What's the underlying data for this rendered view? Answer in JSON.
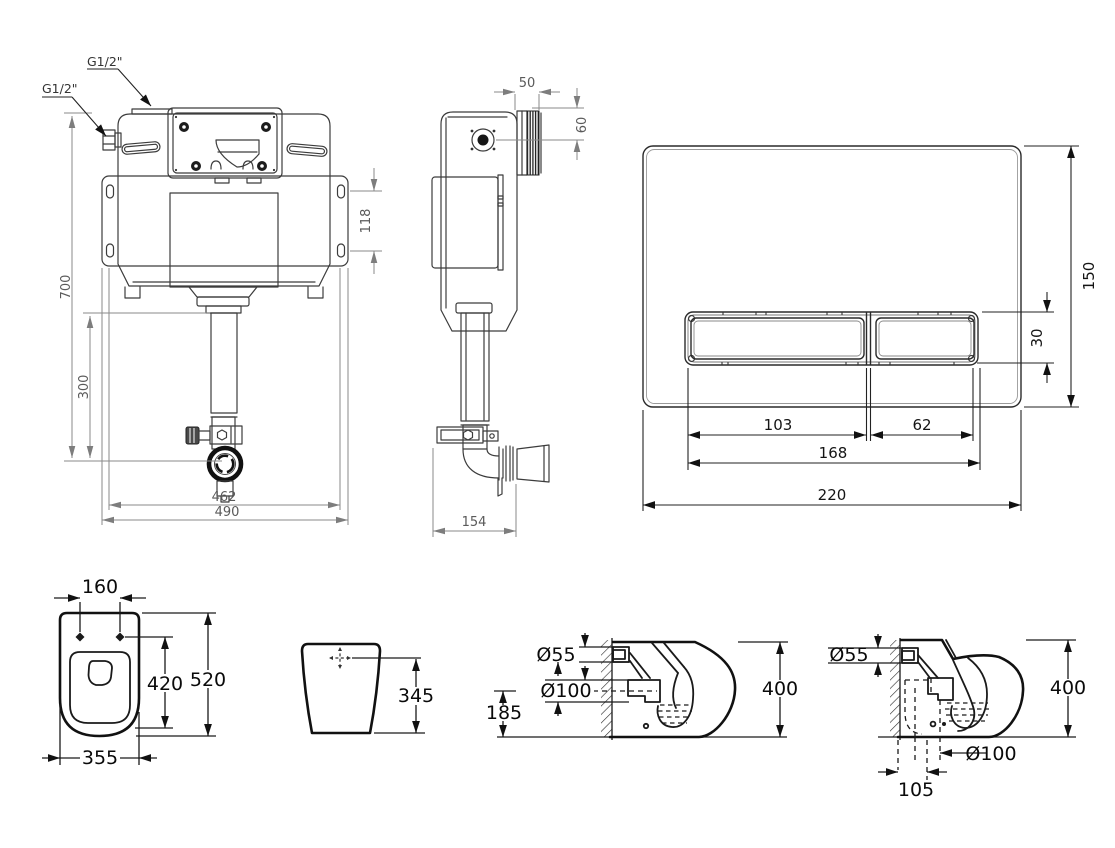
{
  "sheet": {
    "background": "#ffffff",
    "ink_color": "#2a2a2a",
    "dim_color_gray": "#5a5a5a",
    "dim_color_black": "#0a0a0a"
  },
  "views": {
    "cistern_front": {
      "labels": {
        "top_inlet": "G1/2\"",
        "side_inlet": "G1/2\""
      },
      "dims": {
        "total_height": "700",
        "outlet_center_height": "300",
        "bracket_hole_spacing": "118",
        "inner_width": "462",
        "overall_width": "490"
      }
    },
    "cistern_side": {
      "dims": {
        "connector_depth": "50",
        "connector_height": "60",
        "depth": "154"
      }
    },
    "flush_plate": {
      "dims": {
        "plate_height": "150",
        "button_height": "30",
        "large_button_width": "103",
        "small_button_width": "62",
        "buttons_total_width": "168",
        "plate_width": "220"
      }
    },
    "pan_top": {
      "dims": {
        "fixing_hole_spacing": "160",
        "bowl_length": "420",
        "total_length": "520",
        "width": "355"
      }
    },
    "pan_back": {
      "dims": {
        "flush_mark_height": "345"
      }
    },
    "pan_side_wall_outlet": {
      "dims": {
        "inlet_diameter": "Ø55",
        "outlet_diameter": "Ø100",
        "outlet_axis_height": "185",
        "total_height": "400"
      }
    },
    "pan_side_floor_outlet": {
      "dims": {
        "inlet_diameter": "Ø55",
        "total_height": "400",
        "outlet_diameter": "Ø100",
        "outlet_wall_distance": "105"
      }
    }
  }
}
